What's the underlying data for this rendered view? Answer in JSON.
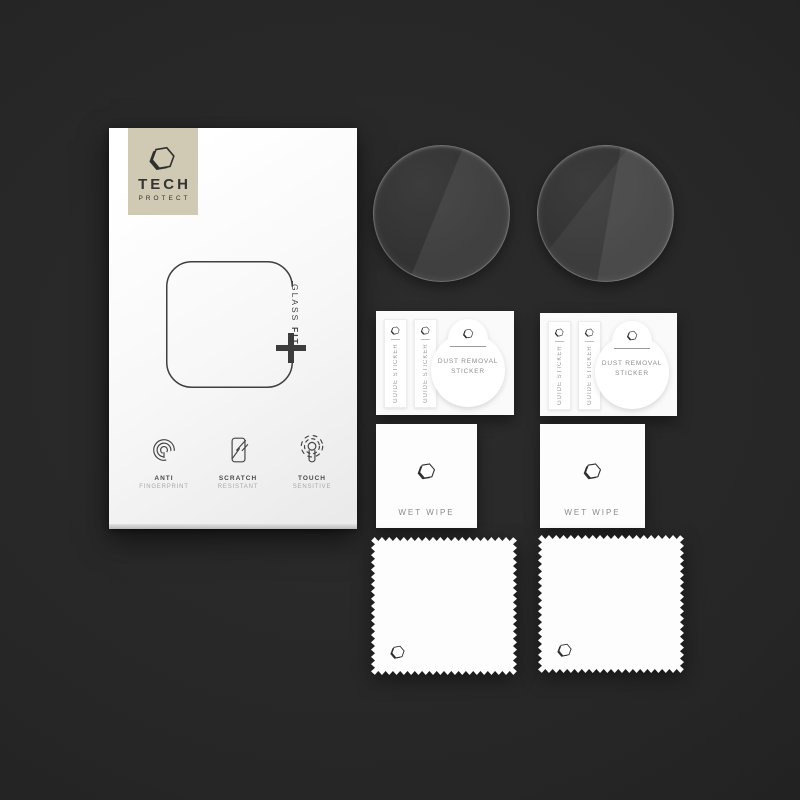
{
  "brand": {
    "title": "TECH",
    "subtitle": "PROTECT",
    "logo_bg": "#d0c9b3"
  },
  "glassfit": {
    "glass": "GLASS",
    "fit": "FIT",
    "plus_glyph": "+"
  },
  "features": [
    {
      "icon": "fingerprint-icon",
      "line1": "ANTI",
      "line2": "FINGERPRINT"
    },
    {
      "icon": "scratch-resistant-icon",
      "line1": "SCRATCH",
      "line2": "RESISTANT"
    },
    {
      "icon": "touch-sensitive-icon",
      "line1": "TOUCH",
      "line2": "SENSITIVE"
    }
  ],
  "sheets": [
    {
      "guide1": "GUIDE STICKER",
      "guide2": "GUIDE STICKER",
      "dust1": "DUST REMOVAL",
      "dust2": "STICKER"
    },
    {
      "guide1": "GUIDE STICKER",
      "guide2": "GUIDE STICKER",
      "dust1": "DUST REMOVAL",
      "dust2": "STICKER"
    }
  ],
  "wipes": [
    {
      "label": "WET WIPE"
    },
    {
      "label": "WET WIPE"
    }
  ],
  "colors": {
    "background": "#262626",
    "box_face": "#f7f7f7",
    "logo_tan": "#d0c9b3",
    "ink": "#3c3c3c",
    "muted_text": "#9a9a9a"
  }
}
